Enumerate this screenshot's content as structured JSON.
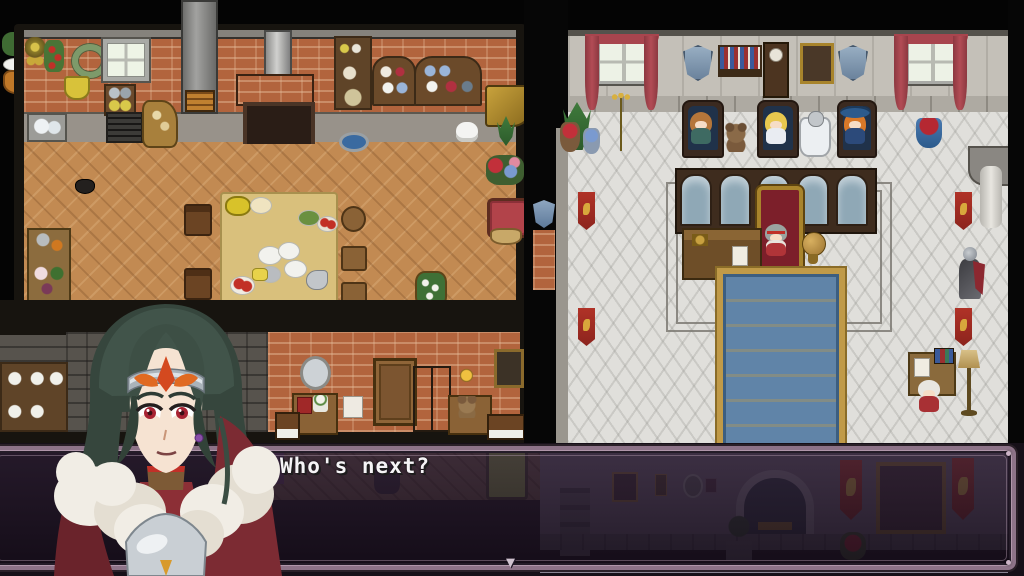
{
  "meta": {
    "screen_width": 1024,
    "screen_height": 576,
    "scene": "rpg-overhead-map-with-dialogue"
  },
  "dialogue": {
    "text": "Who's next?",
    "continue_indicator": "▼"
  },
  "portrait": {
    "label": "hero-portrait",
    "character_features": "dark green hair, silver circlet with red crest, red eyes, white fur mantle, crimson cape, silver breastplate"
  },
  "colors": {
    "background": "#040404",
    "dialogue_frame": "#8d7388",
    "dialogue_frame_highlight": "#b096aa",
    "dialogue_fill": "rgba(28,18,32,0.78)",
    "dialogue_text": "#f5f4f6",
    "kitchen_brick": "#b2643d",
    "kitchen_floor": "#c28a52",
    "throne_wall": "#c4c0b8",
    "throne_floor": "#e0dfdb",
    "curtain_red": "#a8454e",
    "carpet_blue": "#6084a8",
    "carpet_gold": "#c09a48",
    "banner_red": "#b03227",
    "hair_green": "#3a4c42",
    "cape_red": "#7c2b33",
    "fur_white": "#f1ede5",
    "armor_silver": "#c9cfd4",
    "eye_red": "#a82333"
  }
}
